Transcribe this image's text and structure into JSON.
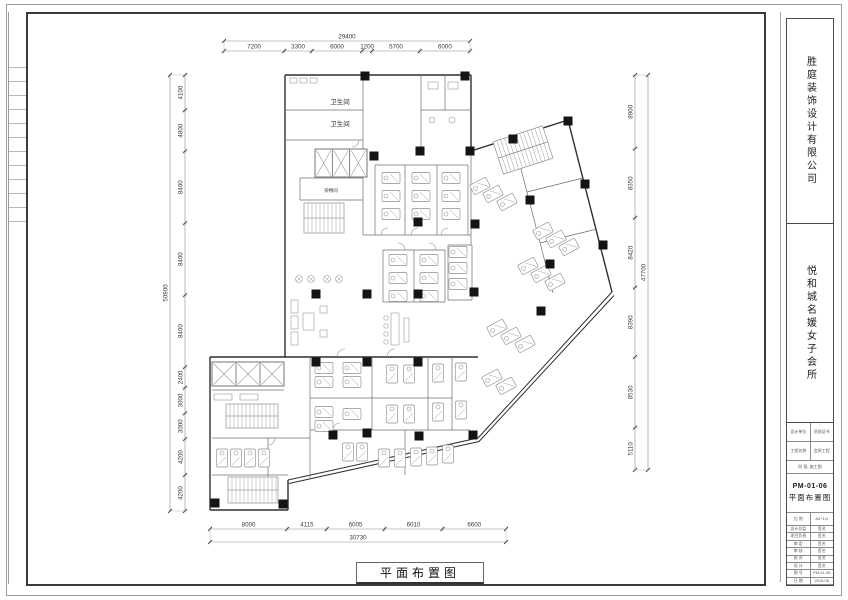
{
  "titlebar": {
    "drawing_title": "平面布置图"
  },
  "titleblock": {
    "company": "胜庭装饰设计有限公司",
    "project": "悦和城名媛女子会所",
    "table": {
      "r1a": "设计单位",
      "r1b": "资质证书",
      "r2a": "工程名称",
      "r2b": "会所工程",
      "r3": "阶 段: 施工图",
      "no": "PM-01-06",
      "name": "平面布置图",
      "r5a": "比 例",
      "r5b": "A2+1/4",
      "rows": [
        [
          "设计总监",
          "签名"
        ],
        [
          "项目负责",
          "签名"
        ],
        [
          "审 定",
          "签名"
        ],
        [
          "审 核",
          "签名"
        ],
        [
          "校 对",
          "签名"
        ],
        [
          "设 计",
          "签名"
        ],
        [
          "图 号",
          "PM-01-06"
        ],
        [
          "日 期",
          "2016.06"
        ]
      ]
    }
  },
  "plan": {
    "room_labels": [
      {
        "t": "卫生间",
        "x": 340,
        "y": 104,
        "s": 6.5
      },
      {
        "t": "卫生间",
        "x": 340,
        "y": 126,
        "s": 6.5
      },
      {
        "t": "杂物间",
        "x": 331,
        "y": 192,
        "s": 4.5
      }
    ],
    "dims": {
      "top": {
        "overall": "29400",
        "segments": [
          7200,
          3300,
          6000,
          1200,
          5700,
          6000
        ]
      },
      "left": {
        "overall": "50900",
        "segments": [
          4100,
          4800,
          8400,
          8400,
          8400,
          2400,
          3000,
          3000,
          4200,
          4200
        ]
      },
      "right": {
        "overall": "47700",
        "segments": [
          8900,
          8350,
          8420,
          8390,
          8530,
          5110
        ]
      },
      "bottom": {
        "overall": "30730",
        "segments": [
          8000,
          4115,
          6005,
          6010,
          6600
        ]
      }
    },
    "walls_main": [
      [
        285,
        75,
        471,
        75
      ],
      [
        285,
        75,
        285,
        357
      ],
      [
        285,
        357,
        210,
        357
      ],
      [
        210,
        357,
        210,
        510
      ],
      [
        210,
        510,
        288,
        510
      ],
      [
        288,
        510,
        288,
        480
      ],
      [
        471,
        75,
        471,
        151
      ],
      [
        471,
        151,
        568,
        120
      ],
      [
        568,
        120,
        612,
        292
      ],
      [
        285,
        357,
        478,
        357
      ]
    ],
    "walls_double": [
      [
        288,
        480,
        478,
        438,
        612,
        292
      ],
      [
        289,
        483.5,
        479,
        441.5,
        614,
        295.5
      ]
    ],
    "walls_int": [
      [
        363,
        75,
        363,
        235
      ],
      [
        285,
        110,
        363,
        110
      ],
      [
        285,
        140,
        363,
        140
      ],
      [
        300,
        178,
        300,
        200
      ],
      [
        300,
        178,
        363,
        178
      ],
      [
        300,
        200,
        363,
        200
      ],
      [
        421,
        75,
        421,
        151
      ],
      [
        421,
        110,
        471,
        110
      ],
      [
        445,
        75,
        445,
        110
      ],
      [
        363,
        235,
        471,
        235
      ],
      [
        375,
        165,
        468,
        165
      ],
      [
        375,
        165,
        375,
        235
      ],
      [
        405,
        165,
        405,
        235
      ],
      [
        437,
        165,
        437,
        235
      ],
      [
        468,
        165,
        468,
        235
      ],
      [
        383,
        250,
        445,
        250
      ],
      [
        383,
        302,
        445,
        302
      ],
      [
        383,
        250,
        383,
        302
      ],
      [
        445,
        250,
        445,
        302
      ],
      [
        414,
        250,
        414,
        302
      ],
      [
        448,
        245,
        472,
        245
      ],
      [
        448,
        300,
        472,
        300
      ],
      [
        448,
        245,
        448,
        300
      ],
      [
        472,
        245,
        472,
        300
      ],
      [
        471,
        151,
        471,
        245
      ],
      [
        513,
        138,
        553,
        293
      ],
      [
        527,
        192,
        583,
        178
      ],
      [
        540,
        243,
        597,
        229
      ],
      [
        310,
        357,
        310,
        478
      ],
      [
        372,
        357,
        372,
        430
      ],
      [
        428,
        357,
        428,
        430
      ],
      [
        452,
        357,
        452,
        430
      ],
      [
        310,
        398,
        452,
        398
      ],
      [
        310,
        430,
        470,
        430
      ],
      [
        405,
        430,
        405,
        475
      ],
      [
        212,
        390,
        284,
        390
      ],
      [
        212,
        438,
        310,
        438
      ],
      [
        268,
        438,
        268,
        478
      ],
      [
        212,
        475,
        288,
        475
      ]
    ],
    "columns": [
      [
        365,
        76
      ],
      [
        465,
        76
      ],
      [
        374,
        156
      ],
      [
        420,
        151
      ],
      [
        470,
        151
      ],
      [
        513,
        139
      ],
      [
        568,
        121
      ],
      [
        585,
        184
      ],
      [
        603,
        245
      ],
      [
        550,
        264
      ],
      [
        530,
        200
      ],
      [
        541,
        311
      ],
      [
        475,
        224
      ],
      [
        418,
        222
      ],
      [
        316,
        294
      ],
      [
        367,
        294
      ],
      [
        418,
        294
      ],
      [
        474,
        292
      ],
      [
        316,
        362
      ],
      [
        367,
        362
      ],
      [
        418,
        362
      ],
      [
        333,
        435
      ],
      [
        367,
        433
      ],
      [
        419,
        436
      ],
      [
        473,
        435
      ],
      [
        283,
        504
      ],
      [
        215,
        503
      ]
    ],
    "elevators": [
      {
        "x": 315,
        "y": 149,
        "w": 52,
        "h": 28,
        "n": 3
      },
      {
        "x": 212,
        "y": 362,
        "w": 72,
        "h": 24,
        "n": 3
      }
    ],
    "stairs": [
      {
        "x": 304,
        "y": 203,
        "w": 40,
        "h": 30,
        "step": 4,
        "rot": 0,
        "cx": 0,
        "cy": 0
      },
      {
        "x": 226,
        "y": 404,
        "w": 52,
        "h": 24,
        "step": 4,
        "rot": 0,
        "cx": 0,
        "cy": 0
      },
      {
        "x": 228,
        "y": 477,
        "w": 50,
        "h": 26,
        "step": 4,
        "rot": 0,
        "cx": 0,
        "cy": 0
      },
      {
        "x": -26,
        "y": -17,
        "w": 52,
        "h": 34,
        "step": 4,
        "rot": -18,
        "cx": 523,
        "cy": 150
      }
    ],
    "beds": [
      [
        391,
        178,
        0
      ],
      [
        391,
        196,
        0
      ],
      [
        391,
        214,
        0
      ],
      [
        421,
        178,
        0
      ],
      [
        421,
        196,
        0
      ],
      [
        421,
        214,
        0
      ],
      [
        451,
        178,
        0
      ],
      [
        451,
        196,
        0
      ],
      [
        451,
        214,
        0
      ],
      [
        398,
        260,
        0
      ],
      [
        398,
        278,
        0
      ],
      [
        398,
        296,
        0
      ],
      [
        429,
        260,
        0
      ],
      [
        429,
        278,
        0
      ],
      [
        429,
        296,
        0
      ],
      [
        458,
        252,
        0
      ],
      [
        458,
        268,
        0
      ],
      [
        458,
        284,
        0
      ],
      [
        324,
        368,
        0
      ],
      [
        324,
        382,
        0
      ],
      [
        352,
        368,
        0
      ],
      [
        352,
        382,
        0
      ],
      [
        392,
        374,
        90
      ],
      [
        409,
        374,
        90
      ],
      [
        438,
        373,
        90
      ],
      [
        461,
        372,
        90
      ],
      [
        324,
        412,
        0
      ],
      [
        324,
        426,
        0
      ],
      [
        352,
        414,
        0
      ],
      [
        392,
        414,
        90
      ],
      [
        409,
        414,
        90
      ],
      [
        438,
        412,
        90
      ],
      [
        461,
        410,
        90
      ],
      [
        222,
        458,
        90
      ],
      [
        236,
        458,
        90
      ],
      [
        250,
        458,
        90
      ],
      [
        264,
        458,
        90
      ],
      [
        348,
        452,
        90
      ],
      [
        362,
        452,
        90
      ],
      [
        384,
        458,
        90
      ],
      [
        400,
        458,
        90
      ],
      [
        416,
        457,
        90
      ],
      [
        432,
        456,
        90
      ],
      [
        448,
        454,
        90
      ],
      [
        480,
        186,
        -28
      ],
      [
        493,
        194,
        -28
      ],
      [
        507,
        202,
        -28
      ],
      [
        543,
        231,
        -28
      ],
      [
        556,
        239,
        -28
      ],
      [
        569,
        247,
        -28
      ],
      [
        528,
        266,
        -28
      ],
      [
        541,
        274,
        -28
      ],
      [
        555,
        282,
        -28
      ],
      [
        497,
        328,
        -28
      ],
      [
        511,
        336,
        -28
      ],
      [
        525,
        344,
        -28
      ],
      [
        492,
        378,
        -28
      ],
      [
        506,
        386,
        -28
      ]
    ],
    "arcs": [
      [
        388,
        235,
        7,
        180
      ],
      [
        418,
        235,
        7,
        180
      ],
      [
        448,
        235,
        7,
        180
      ],
      [
        398,
        250,
        7,
        270
      ],
      [
        429,
        250,
        7,
        270
      ],
      [
        352,
        140,
        7,
        0
      ],
      [
        345,
        357,
        8,
        180
      ],
      [
        395,
        357,
        8,
        180
      ],
      [
        340,
        430,
        7,
        180
      ],
      [
        268,
        438,
        7,
        0
      ]
    ],
    "fix_rects": [
      [
        290,
        78,
        7,
        5
      ],
      [
        300,
        78,
        7,
        5
      ],
      [
        310,
        78,
        7,
        5
      ],
      [
        428,
        82,
        10,
        7
      ],
      [
        448,
        82,
        10,
        7
      ],
      [
        303,
        313,
        11,
        17
      ],
      [
        291,
        300,
        7,
        13
      ],
      [
        291,
        316,
        7,
        13
      ],
      [
        291,
        332,
        7,
        13
      ],
      [
        320,
        306,
        7,
        7
      ],
      [
        320,
        330,
        7,
        7
      ],
      [
        391,
        313,
        8,
        32
      ],
      [
        404,
        318,
        5,
        24
      ],
      [
        214,
        394,
        18,
        6
      ],
      [
        240,
        394,
        18,
        6
      ]
    ],
    "fix_circles": [
      [
        432,
        120,
        3
      ],
      [
        452,
        120,
        3
      ],
      [
        386,
        318,
        2.2
      ],
      [
        386,
        326,
        2.2
      ],
      [
        386,
        334,
        2.2
      ],
      [
        386,
        342,
        2.2
      ]
    ],
    "x_circles": [
      [
        299,
        279,
        3.5
      ],
      [
        311,
        279,
        3.5
      ],
      [
        327,
        279,
        3.5
      ],
      [
        339,
        279,
        3.5
      ]
    ]
  }
}
